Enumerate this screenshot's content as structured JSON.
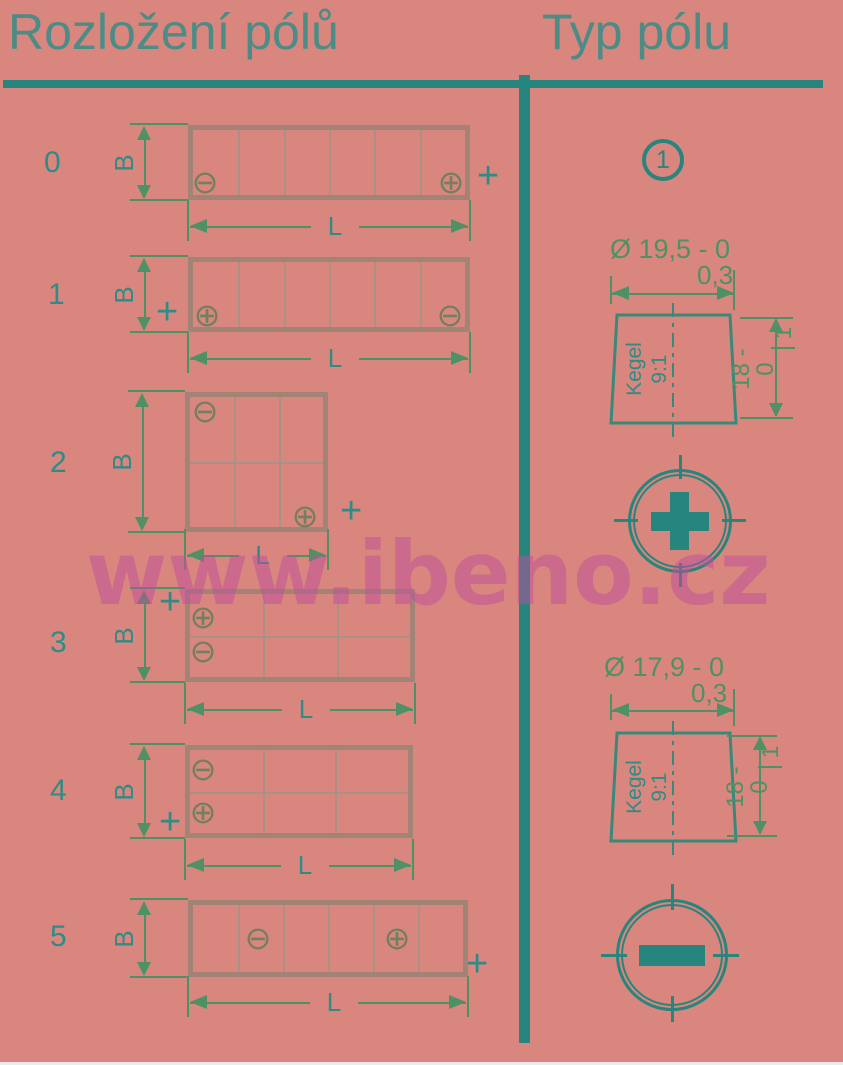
{
  "header": {
    "left_title": "Rozložení pólů",
    "right_title": "Typ pólu"
  },
  "watermark": "www.ibeno.cz",
  "symbols": {
    "plus_terminal": "⊕",
    "minus_terminal": "⊖",
    "plus_sign": "+"
  },
  "dimensions": {
    "width_label": "B",
    "length_label": "L"
  },
  "rows": [
    {
      "label": "0",
      "negative_position": "bottom-left",
      "positive_position": "bottom-right",
      "external_plus": "right"
    },
    {
      "label": "1",
      "negative_position": "bottom-right",
      "positive_position": "bottom-left",
      "external_plus": "left"
    },
    {
      "label": "2",
      "negative_position": "top-left",
      "positive_position": "bottom-right",
      "external_plus": "right"
    },
    {
      "label": "3",
      "negative_position": "middle-left",
      "positive_position": "top-left",
      "external_plus": "top-left"
    },
    {
      "label": "4",
      "negative_position": "top-left",
      "positive_position": "middle-left",
      "external_plus": "bottom-left"
    },
    {
      "label": "5",
      "negative_position": "center-cell-2",
      "positive_position": "center-cell-5",
      "external_plus": "bottom-right"
    }
  ],
  "pole_section": {
    "type_number": "1",
    "cone_label": "Kegel",
    "cone_ratio": "9:1",
    "poles": [
      {
        "diameter": "Ø 19,5 - 0",
        "diameter_tolerance": "0,3",
        "height": "18 - 0",
        "height_tolerance": "1",
        "polarity": "plus"
      },
      {
        "diameter": "Ø 17,9 - 0",
        "diameter_tolerance": "0,3",
        "height": "18 - 0",
        "height_tolerance": "1",
        "polarity": "minus"
      }
    ]
  },
  "palette": {
    "background": "#d9867e",
    "teal_line": "#26857c",
    "title_teal": "#4b8c86",
    "label_teal": "#2f8b85",
    "dimension_green": "#4e9164",
    "battery_outline": "#a28477",
    "terminal_olive": "#72805f",
    "watermark_magenta": "#bf4d9d"
  }
}
